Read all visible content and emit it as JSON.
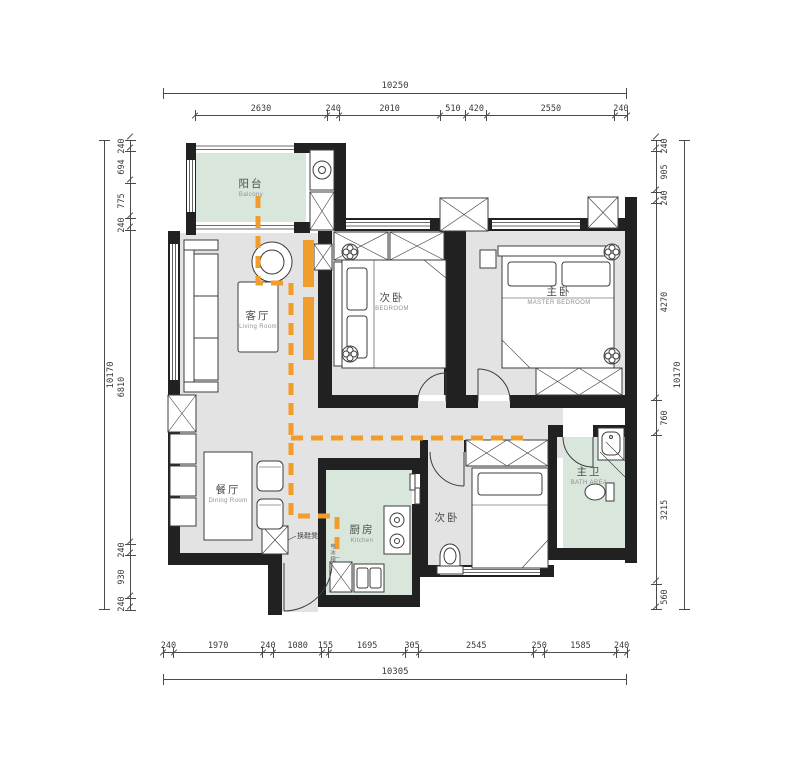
{
  "colors": {
    "wall": "#212121",
    "room_gray": "#e3e3e3",
    "room_green": "#d8e6dc",
    "path_orange": "#f09d2e",
    "dim_line": "#4a4a4a",
    "dim_text": "#3a3a3a",
    "line": "#3c3c3c",
    "label_zh": "#4a4a4a",
    "label_en": "#909090"
  },
  "rooms": {
    "balcony": {
      "zh": "阳台",
      "en": "Balcony"
    },
    "living": {
      "zh": "客厅",
      "en": "Living Room"
    },
    "bedroom_top": {
      "zh": "次卧",
      "en": "BEDROOM"
    },
    "master": {
      "zh": "主卧",
      "en": "MASTER BEDROOM"
    },
    "dining": {
      "zh": "餐厅",
      "en": "Dining Room"
    },
    "kitchen": {
      "zh": "厨房",
      "en": "Kitchen"
    },
    "bedroom_bottom": {
      "zh": "次卧",
      "en": ""
    },
    "bath": {
      "zh": "主卫",
      "en": "BATH AREA"
    }
  },
  "annotations": {
    "shoe_bench": "换鞋凳",
    "fridge": "电冰箱"
  },
  "dimensions": {
    "top": {
      "total": "10250",
      "segments": [
        2630,
        240,
        2010,
        510,
        420,
        2550,
        240
      ]
    },
    "bottom": {
      "total": "10305",
      "segments": [
        240,
        1970,
        240,
        1080,
        155,
        1695,
        305,
        2545,
        250,
        1585,
        240
      ]
    },
    "left": {
      "total": "10170",
      "segments": [
        240,
        694,
        775,
        240,
        6810,
        240,
        930,
        240
      ]
    },
    "right": {
      "total": "10170",
      "segments": [
        240,
        905,
        240,
        4270,
        760,
        3215,
        560
      ]
    }
  }
}
